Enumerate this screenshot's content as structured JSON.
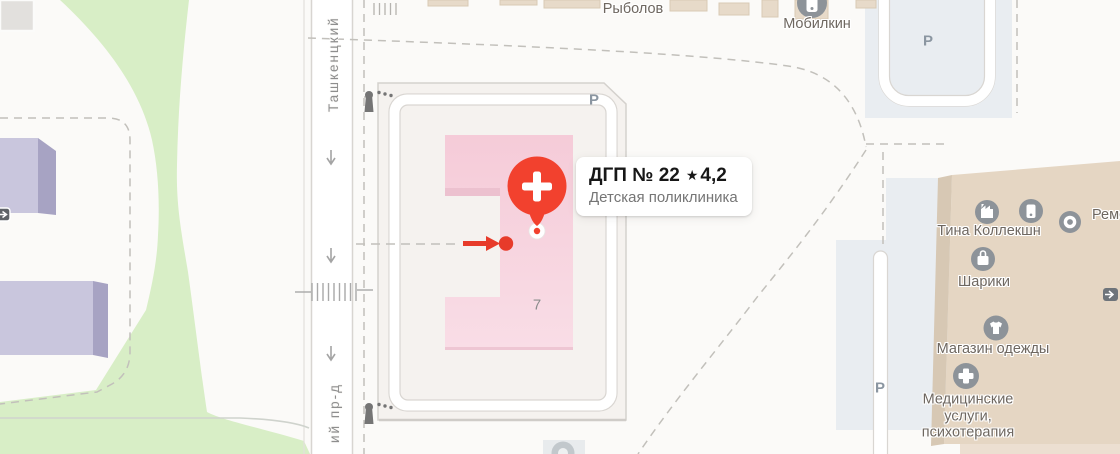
{
  "place_card": {
    "title": "ДГП № 22",
    "star": "★",
    "rating": "4,2",
    "subtitle": "Детская поликлиника"
  },
  "selected_building": {
    "number": "7"
  },
  "street": {
    "label_top": "Ташкенцкий",
    "label_bottom": "ий пр-д"
  },
  "parking": {
    "label": "Р"
  },
  "pois": {
    "rybolov": "Рыболов",
    "mobilkin": "Мобилкин",
    "tina_kollekshn": "Тина Коллекшн",
    "shariki": "Шарики",
    "magazin_odezhdy": "Магазин одежды",
    "med_uslugi": "Медицинские услуги, психотерапия",
    "remont_clipped": "Ремо"
  },
  "colors": {
    "selected_building_pink": "#f6cfdb",
    "marker_red": "#f2412e",
    "entrance_red": "#e73b2a",
    "poi_icon_gray": "#8d9399",
    "green_area": "#d8eec6",
    "residential_purple": "#c9c6dd",
    "commercial_beige": "#e5d6c3",
    "parking_zone": "#e9edf1",
    "grounds_fill": "#f5f2ef",
    "card_bg": "#ffffff"
  }
}
